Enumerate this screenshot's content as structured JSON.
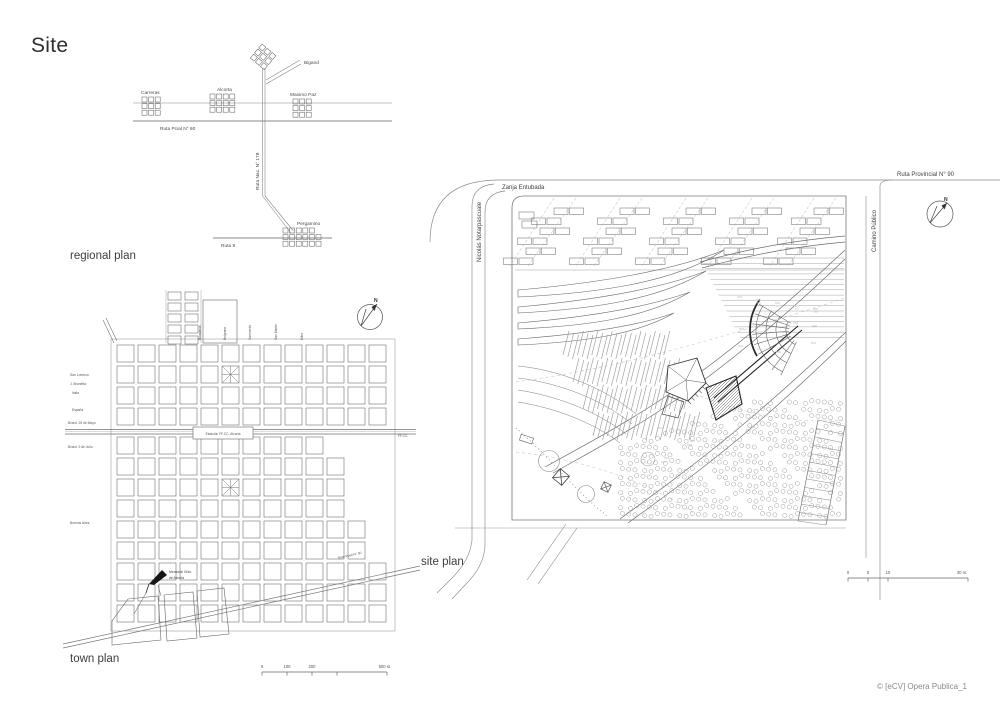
{
  "page": {
    "title": "Site",
    "credit": "© [eCV] Opera Publica_1"
  },
  "regional_plan": {
    "label": "regional plan",
    "towns": {
      "carreras": "Carreras",
      "alcorta": "Alcorta",
      "maximo_paz": "Maximo Paz",
      "bigand": "Bigand",
      "pergamino": "Pergamino"
    },
    "roads": {
      "ruta_pcial_90": "Ruta Pcial N° 90",
      "ruta_nac_178": "Ruta Nac. N° 178",
      "ruta_8": "Ruta 8"
    }
  },
  "town_plan": {
    "label": "town plan",
    "streets_left": [
      "San Lorenzo",
      "J. Brunetta",
      "Italia",
      "España",
      "Bvard. 25 de Mayo",
      "Bvard. 9 de Julio",
      "Buenos Aires"
    ],
    "streets_top": [
      "Rivadavia",
      "Belgrano",
      "Sarmiento",
      "San Martín",
      "Mitre"
    ],
    "station": "Estación FF.CC. Alcorta",
    "railway_label": "FF.CC.",
    "road_diagonal": "Ruta Pcial N° 90",
    "memorial_line1": "Memorial Grito",
    "memorial_line2": "de Alcorta",
    "north": "N",
    "scale": {
      "t0": "0",
      "t1": "100",
      "t2": "200",
      "end": "500 m."
    }
  },
  "site_plan": {
    "label": "site plan",
    "roads": {
      "zanja": "Zanja Entubada",
      "nicolas": "Nicolás Notarpascuale",
      "ruta_prov": "Ruta Provincial N° 90",
      "camino": "Camino Público"
    },
    "north": "N",
    "scale": {
      "t0": "0",
      "t1": "5",
      "t2": "10",
      "end": "30 m."
    }
  }
}
